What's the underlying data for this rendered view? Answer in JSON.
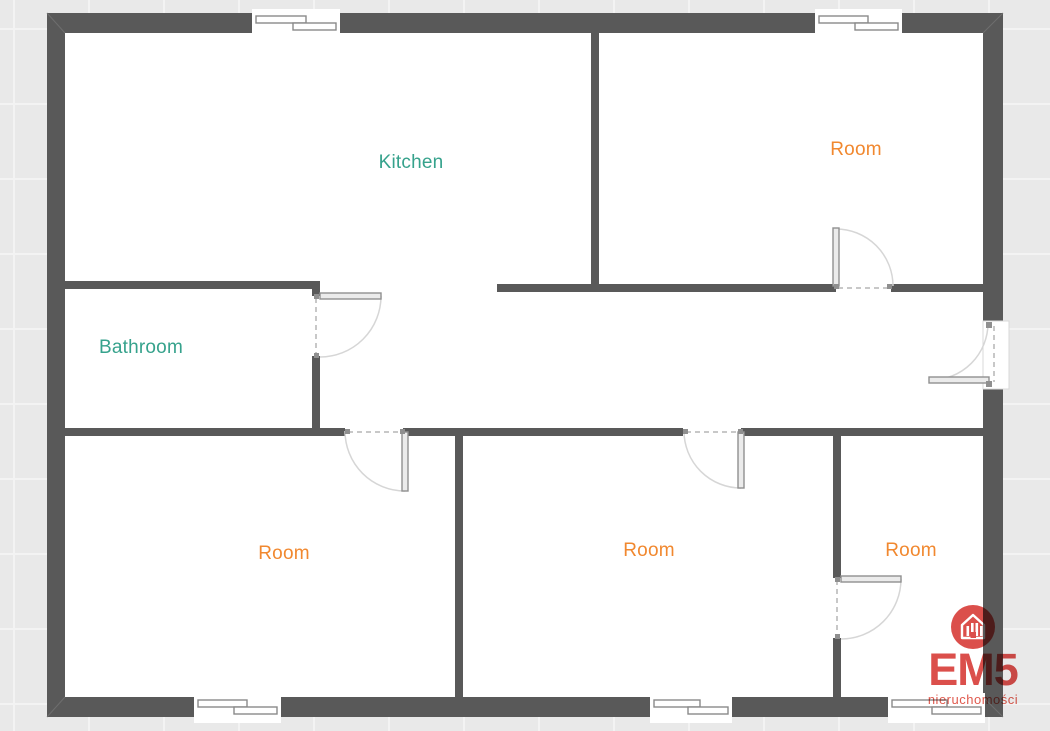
{
  "rooms": {
    "kitchen": {
      "label": "Kitchen",
      "color": "#36a28c"
    },
    "room_top_right": {
      "label": "Room",
      "color": "#f1882f"
    },
    "bathroom": {
      "label": "Bathroom",
      "color": "#36a28c"
    },
    "room_bottom_left": {
      "label": "Room",
      "color": "#f1882f"
    },
    "room_bottom_middle": {
      "label": "Room",
      "color": "#f1882f"
    },
    "room_bottom_right": {
      "label": "Room",
      "color": "#f1882f"
    }
  },
  "logo": {
    "name": "EM5",
    "subtitle": "nieruchomości",
    "icon": "house-buildings-logo-icon",
    "color": "#db4f4b"
  },
  "colors": {
    "wall": "#595959",
    "floor": "#ffffff",
    "background": "#e9e9e9",
    "door_arc": "#d6d6d6",
    "door_leaf": "#ebebeb",
    "window_frame": "#8a8a8a",
    "teal_label": "#36a28c",
    "orange_label": "#f1882f",
    "logo_red": "#db4f4b"
  }
}
